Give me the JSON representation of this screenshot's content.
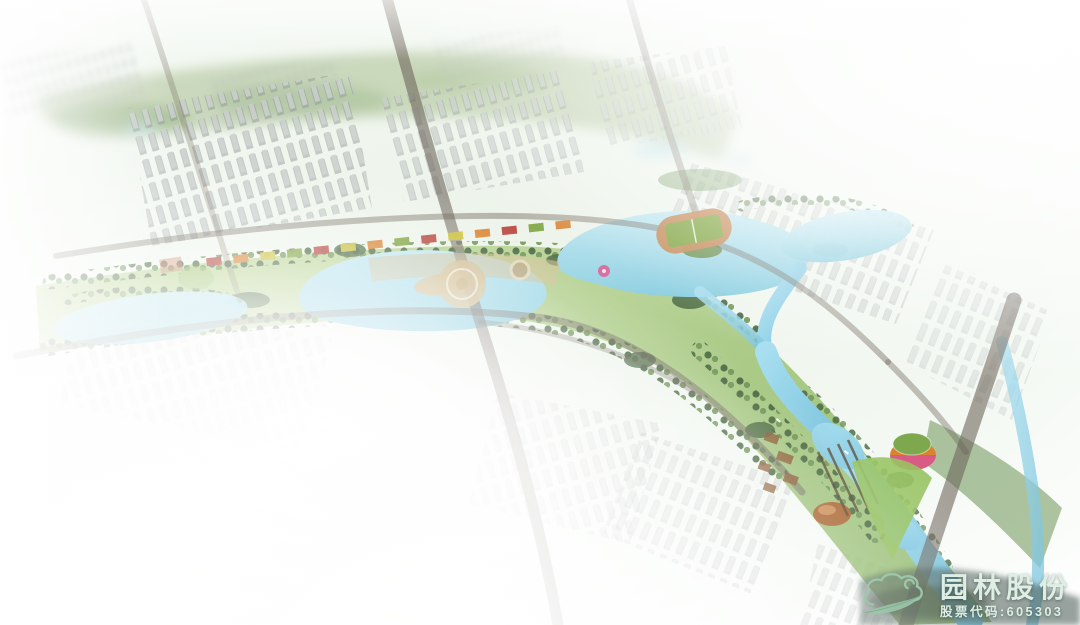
{
  "watermark": {
    "brand_name": "园林股份",
    "stock_code": "股票代码:605303",
    "logo_icon": "cloud-leaf-icon"
  },
  "palette": {
    "bg_tint": "#edf4ea",
    "city_light": "#c9cecc",
    "city_shadow": "#8e9795",
    "tree_dark": "#44633c",
    "tree_mid": "#6d9355",
    "lawn": "#97c262",
    "water": "#a9dcea",
    "water_deep": "#7cc3db",
    "road": "#6e655b",
    "plaza_tan": "#d3c096",
    "accent_red": "#b8443c",
    "accent_orange": "#d9832f",
    "accent_yellow": "#cfc23e",
    "accent_green": "#7ea43e",
    "accent_pink": "#d8568f",
    "dome_copper": "#a8642f",
    "distant_sage": "#aabf92",
    "mist": "#ffffff",
    "brand_icon": "#9cc7ab",
    "brand_text": "#dfeee4"
  }
}
